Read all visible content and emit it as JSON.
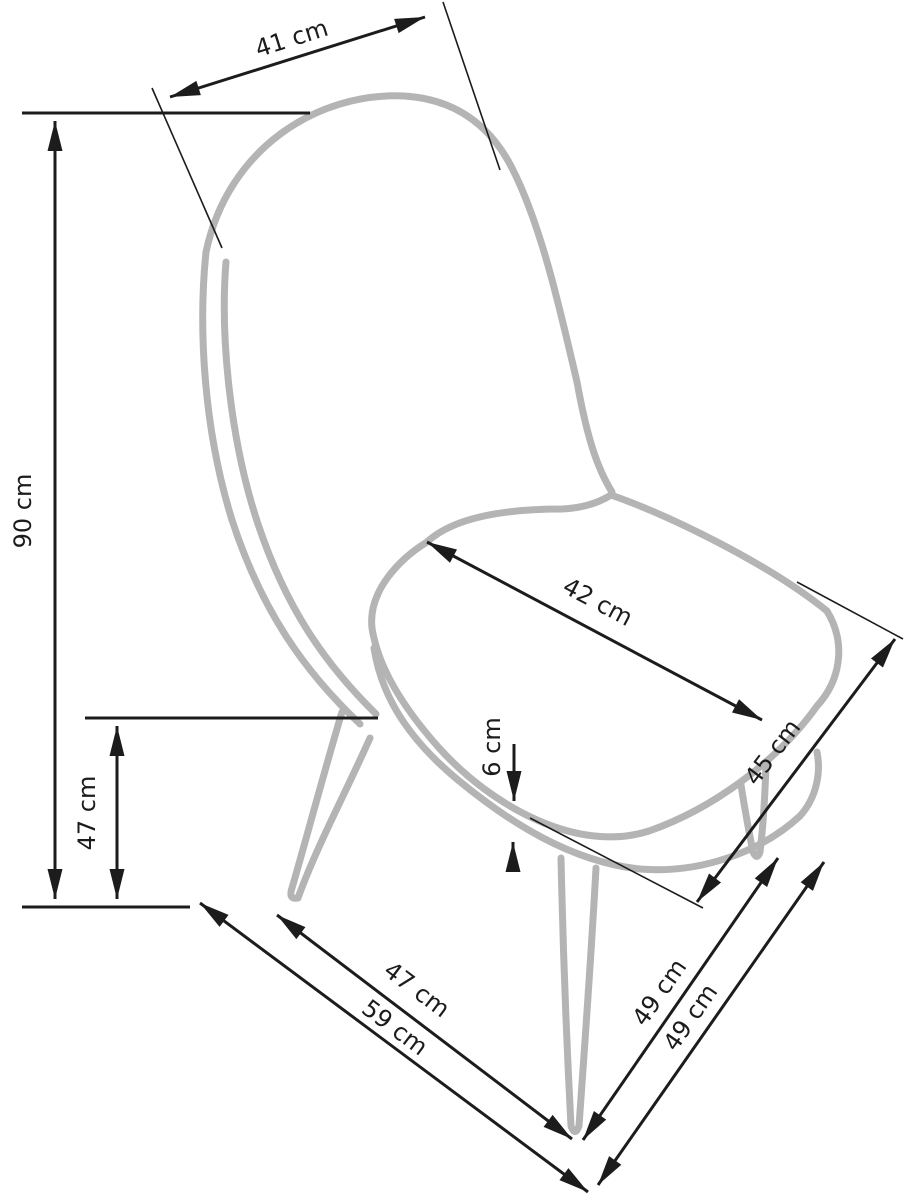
{
  "figure": {
    "type": "furniture-dimension-diagram",
    "subject": "side-view sketch of an upholstered chair with metal cone legs",
    "background_color": "#ffffff",
    "dimension_color": "#1c1c1c",
    "chair_outline_color": "#b4b4b4",
    "unit": "cm"
  },
  "dimensions": {
    "backrest_top_width": "41 cm",
    "overall_height": "90 cm",
    "seat_height": "47 cm",
    "seat_depth_top": "42 cm",
    "cushion_thickness": "6 cm",
    "seat_front_width": "45 cm",
    "floor_span_legs": "47 cm",
    "floor_depth_overall": "59 cm",
    "leg_span_side_inner": "49 cm",
    "leg_span_side_outer": "49 cm"
  }
}
